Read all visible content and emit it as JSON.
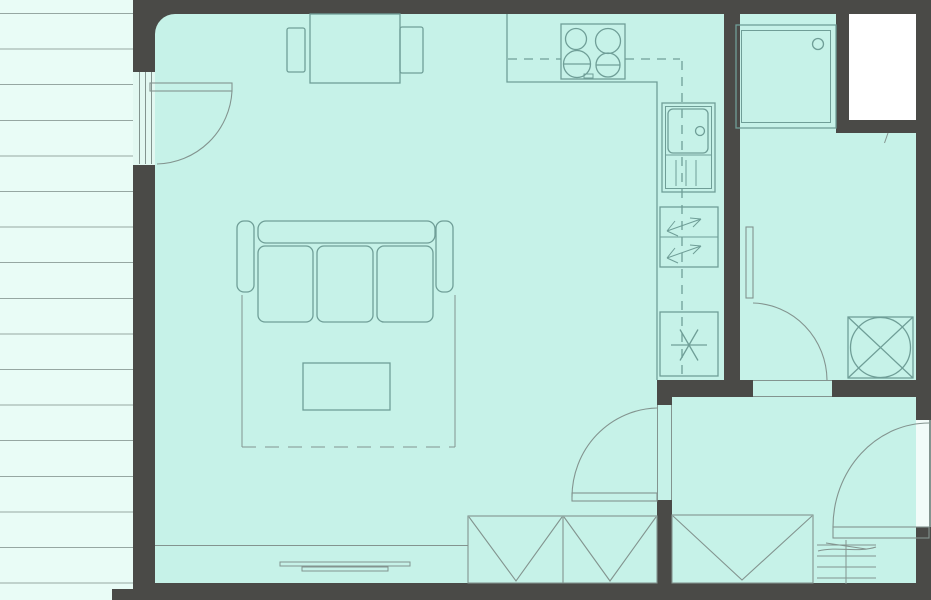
{
  "title": "apartment-floor-plan",
  "canvas": {
    "width": 931,
    "height": 600
  },
  "colors": {
    "wall": "#4a4a47",
    "floor": "#c6f2e8",
    "balcony": "#e9fcf6",
    "stripe": "#96a7a2",
    "line": "#6f9e97",
    "soft": "#83948f",
    "shaft": "#ffffff",
    "glass": "#e2f8f1",
    "entry": "#f2fcf9"
  },
  "rooms": [
    {
      "name": "balcony"
    },
    {
      "name": "living-room"
    },
    {
      "name": "kitchen"
    },
    {
      "name": "bathroom"
    },
    {
      "name": "hallway"
    },
    {
      "name": "light-shaft"
    }
  ],
  "furniture": [
    {
      "name": "dining-table"
    },
    {
      "name": "dining-chair-left"
    },
    {
      "name": "dining-chair-right"
    },
    {
      "name": "sofa-three-seat"
    },
    {
      "name": "rug"
    },
    {
      "name": "coffee-table"
    },
    {
      "name": "sideboard"
    },
    {
      "name": "wardrobe-living"
    },
    {
      "name": "wardrobe-hall"
    },
    {
      "name": "doormat-grate"
    }
  ],
  "fixtures": [
    {
      "name": "stove-four-burners"
    },
    {
      "name": "kitchen-sink"
    },
    {
      "name": "refrigerator"
    },
    {
      "name": "freezer"
    },
    {
      "name": "kitchen-counter"
    },
    {
      "name": "shower"
    },
    {
      "name": "washing-machine"
    }
  ],
  "doors": [
    {
      "name": "balcony-door"
    },
    {
      "name": "living-hall-door"
    },
    {
      "name": "bathroom-door"
    },
    {
      "name": "entrance-door"
    }
  ]
}
